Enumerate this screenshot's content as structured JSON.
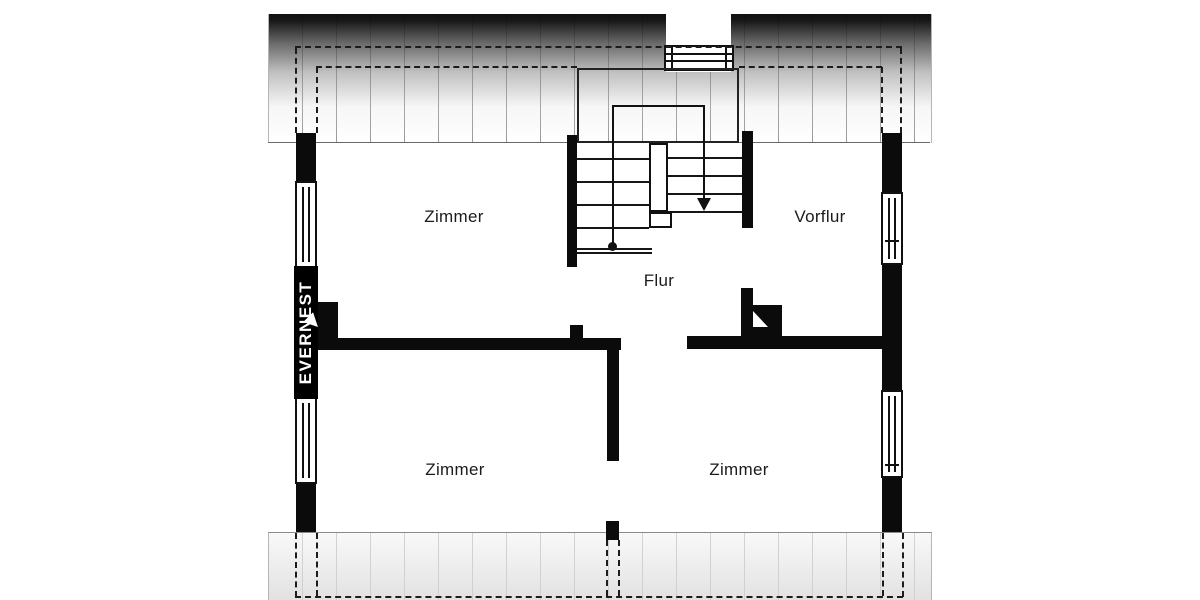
{
  "plan": {
    "rooms": [
      {
        "name": "zimmer-top-left",
        "label": "Zimmer"
      },
      {
        "name": "vorflur",
        "label": "Vorflur"
      },
      {
        "name": "flur",
        "label": "Flur"
      },
      {
        "name": "zimmer-bottom-left",
        "label": "Zimmer"
      },
      {
        "name": "zimmer-bottom-right",
        "label": "Zimmer"
      }
    ],
    "watermark": {
      "text": "EVERNEST"
    },
    "colors": {
      "wall": "#000000",
      "roof_gradient_top": "#161616",
      "hatch_line": "#9a9a9a",
      "dashed_line": "#1c1c1c",
      "label_text": "#1b1b1b",
      "watermark_bg": "#000000",
      "watermark_text": "#ffffff"
    }
  }
}
